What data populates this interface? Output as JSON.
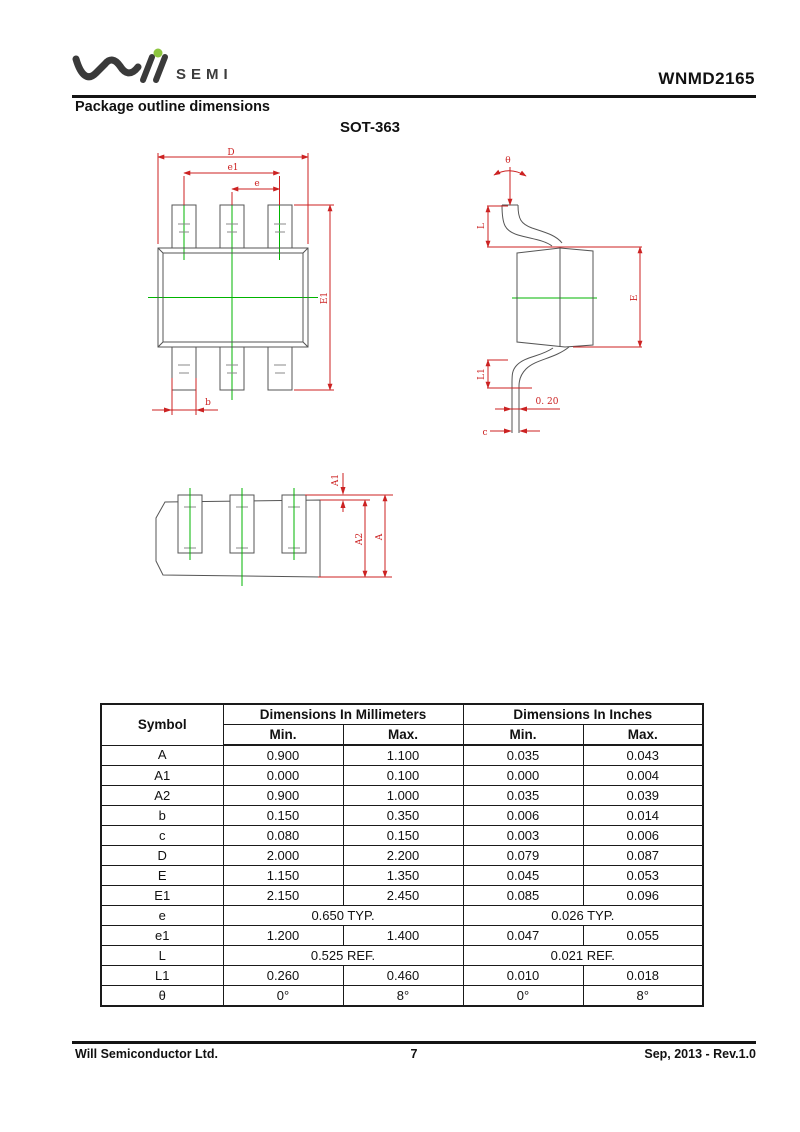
{
  "colors": {
    "dimension_line": "#cc2222",
    "center_line": "#00b400",
    "drawing_outline": "#555555",
    "logo_dot": "#8dc63f",
    "text": "#111111"
  },
  "header": {
    "logo_suffix": "SEMI",
    "part_number": "WNMD2165"
  },
  "content": {
    "section_title": "Package outline dimensions",
    "package_name": "SOT-363"
  },
  "drawings": {
    "top_view": {
      "d": "D",
      "e1": "e1",
      "e": "e",
      "E1": "E1",
      "b": "b"
    },
    "side_view": {
      "theta": "θ",
      "L": "L",
      "E": "E",
      "L1": "L1",
      "tip": "0. 20",
      "c": "c"
    },
    "front_view": {
      "A1": "A1",
      "A2": "A2",
      "A": "A"
    }
  },
  "table": {
    "header": {
      "symbol": "Symbol",
      "mm_group": "Dimensions In Millimeters",
      "inch_group": "Dimensions In Inches",
      "min": "Min.",
      "max": "Max."
    },
    "rows": [
      {
        "symbol": "A",
        "mm_min": "0.900",
        "mm_max": "1.100",
        "in_min": "0.035",
        "in_max": "0.043"
      },
      {
        "symbol": "A1",
        "mm_min": "0.000",
        "mm_max": "0.100",
        "in_min": "0.000",
        "in_max": "0.004"
      },
      {
        "symbol": "A2",
        "mm_min": "0.900",
        "mm_max": "1.000",
        "in_min": "0.035",
        "in_max": "0.039"
      },
      {
        "symbol": "b",
        "mm_min": "0.150",
        "mm_max": "0.350",
        "in_min": "0.006",
        "in_max": "0.014"
      },
      {
        "symbol": "c",
        "mm_min": "0.080",
        "mm_max": "0.150",
        "in_min": "0.003",
        "in_max": "0.006"
      },
      {
        "symbol": "D",
        "mm_min": "2.000",
        "mm_max": "2.200",
        "in_min": "0.079",
        "in_max": "0.087"
      },
      {
        "symbol": "E",
        "mm_min": "1.150",
        "mm_max": "1.350",
        "in_min": "0.045",
        "in_max": "0.053"
      },
      {
        "symbol": "E1",
        "mm_min": "2.150",
        "mm_max": "2.450",
        "in_min": "0.085",
        "in_max": "0.096"
      },
      {
        "symbol": "e",
        "span": true,
        "mm_span": "0.650 TYP.",
        "in_span": "0.026 TYP."
      },
      {
        "symbol": "e1",
        "mm_min": "1.200",
        "mm_max": "1.400",
        "in_min": "0.047",
        "in_max": "0.055"
      },
      {
        "symbol": "L",
        "span": true,
        "mm_span": "0.525 REF.",
        "in_span": "0.021 REF."
      },
      {
        "symbol": "L1",
        "mm_min": "0.260",
        "mm_max": "0.460",
        "in_min": "0.010",
        "in_max": "0.018"
      },
      {
        "symbol": "θ",
        "mm_min": "0°",
        "mm_max": "8°",
        "in_min": "0°",
        "in_max": "8°"
      }
    ]
  },
  "footer": {
    "company": "Will Semiconductor Ltd.",
    "page_number": "7",
    "date_rev": "Sep, 2013 - Rev.1.0"
  }
}
